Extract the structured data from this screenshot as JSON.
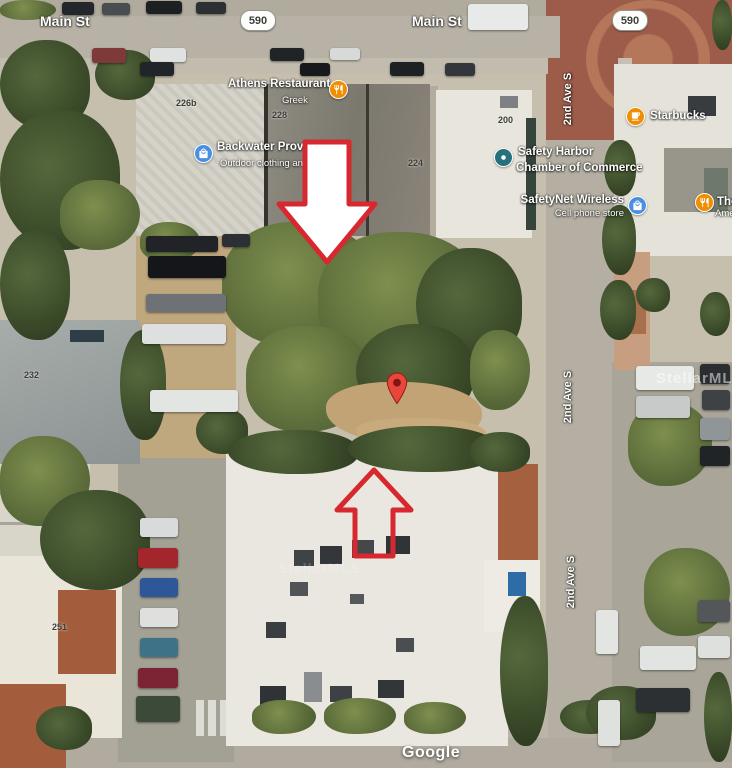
{
  "map_labels": {
    "main_st_west": "Main St",
    "main_st_east": "Main St",
    "route_west": "590",
    "route_east": "590",
    "ave_north": "2nd Ave S",
    "ave_mid": "2nd Ave S",
    "ave_south": "2nd Ave S"
  },
  "pois": {
    "athens": {
      "name": "Athens Restaurant",
      "subtitle": "Greek",
      "icon": "restaurant-icon"
    },
    "backwater": {
      "name": "Backwater Provision",
      "subtitle": "Outdoor clothing and equ",
      "icon": "shopping-bag-icon"
    },
    "chamber": {
      "line1": "Safety Harbor",
      "line2": "Chamber of Commerce",
      "icon": "civic-icon"
    },
    "safetynet": {
      "name": "SafetyNet Wireless",
      "subtitle": "Cell phone store",
      "icon": "shopping-bag-icon"
    },
    "starbucks": {
      "name": "Starbucks",
      "icon": "cafe-icon"
    },
    "truncated_poi": {
      "name": "The",
      "subtitle": "Ame",
      "icon": "restaurant-icon"
    }
  },
  "building_numbers": {
    "n226b": "226b",
    "n228": "228",
    "n224": "224",
    "n200": "200",
    "n232": "232",
    "n251": "251"
  },
  "watermarks": {
    "google": "Google",
    "stellar": "StellarMLS"
  },
  "annotations": {
    "pin": "location-pin",
    "down_arrow": "subject-lot-arrow-down",
    "up_arrow": "subject-building-arrow-up"
  },
  "colors": {
    "poi_orange": "#EF8E00",
    "poi_blue": "#4A90E2",
    "poi_teal": "#27707E",
    "arrow_red": "#D7282F",
    "pin_red": "#E8453C",
    "pin_core": "#7F1710",
    "shield_bg": "#FDFDFB"
  }
}
